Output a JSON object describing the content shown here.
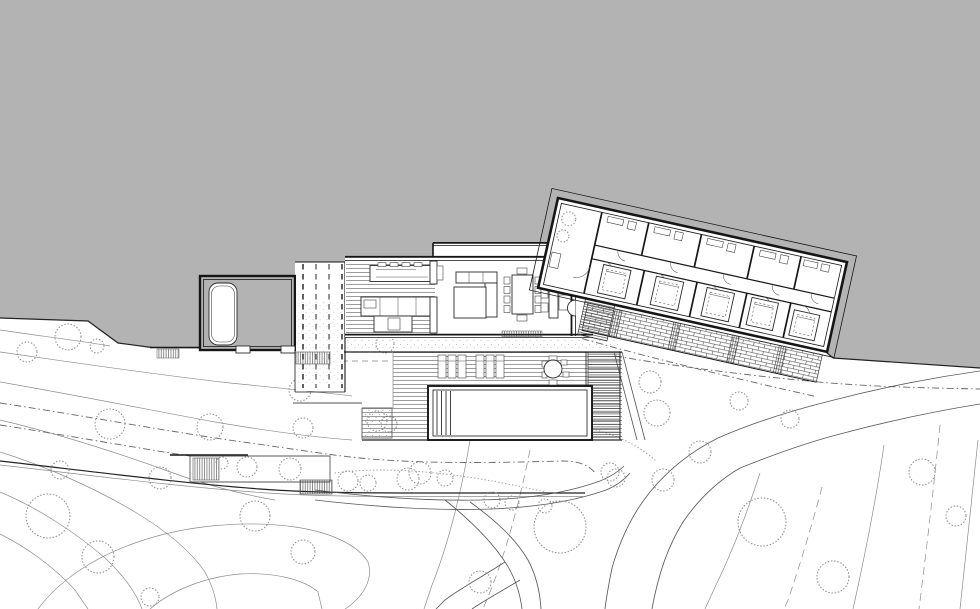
{
  "scene": {
    "type": "architectural-site-plan"
  },
  "colors": {
    "backdrop": "#b3b3b3",
    "paper": "#ffffff",
    "ink": "#161616",
    "furniture": "#2b2b2b",
    "terrain": "#8c8c8c",
    "road": "#5a5a5a",
    "vegetation": "#909090",
    "hidden_line": "#b5b5b5"
  }
}
